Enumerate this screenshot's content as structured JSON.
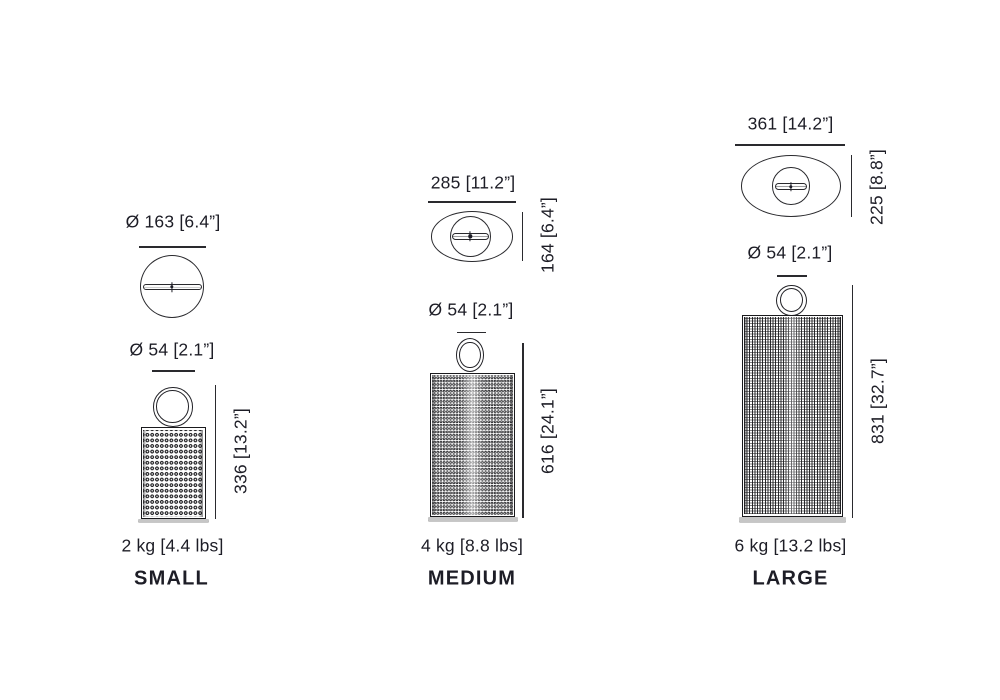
{
  "products": [
    {
      "name": "SMALL",
      "weight": "2 kg [4.4 lbs]",
      "top_diameter": "Ø 163 [6.4”]",
      "handle_diameter": "Ø 54 [2.1”]",
      "height": "336 [13.2”]"
    },
    {
      "name": "MEDIUM",
      "weight": "4 kg [8.8 lbs]",
      "top_width": "285 [11.2”]",
      "top_depth": "164 [6.4”]",
      "handle_diameter": "Ø 54 [2.1”]",
      "height": "616 [24.1”]"
    },
    {
      "name": "LARGE",
      "weight": "6 kg [13.2 lbs]",
      "top_width": "361 [14.2”]",
      "top_depth": "225 [8.8”]",
      "handle_diameter": "Ø 54 [2.1”]",
      "height": "831 [32.7”]"
    }
  ],
  "colors": {
    "ink": "#1d1d26",
    "line": "#2a2a2e",
    "base_gray": "#c6c6c6"
  }
}
